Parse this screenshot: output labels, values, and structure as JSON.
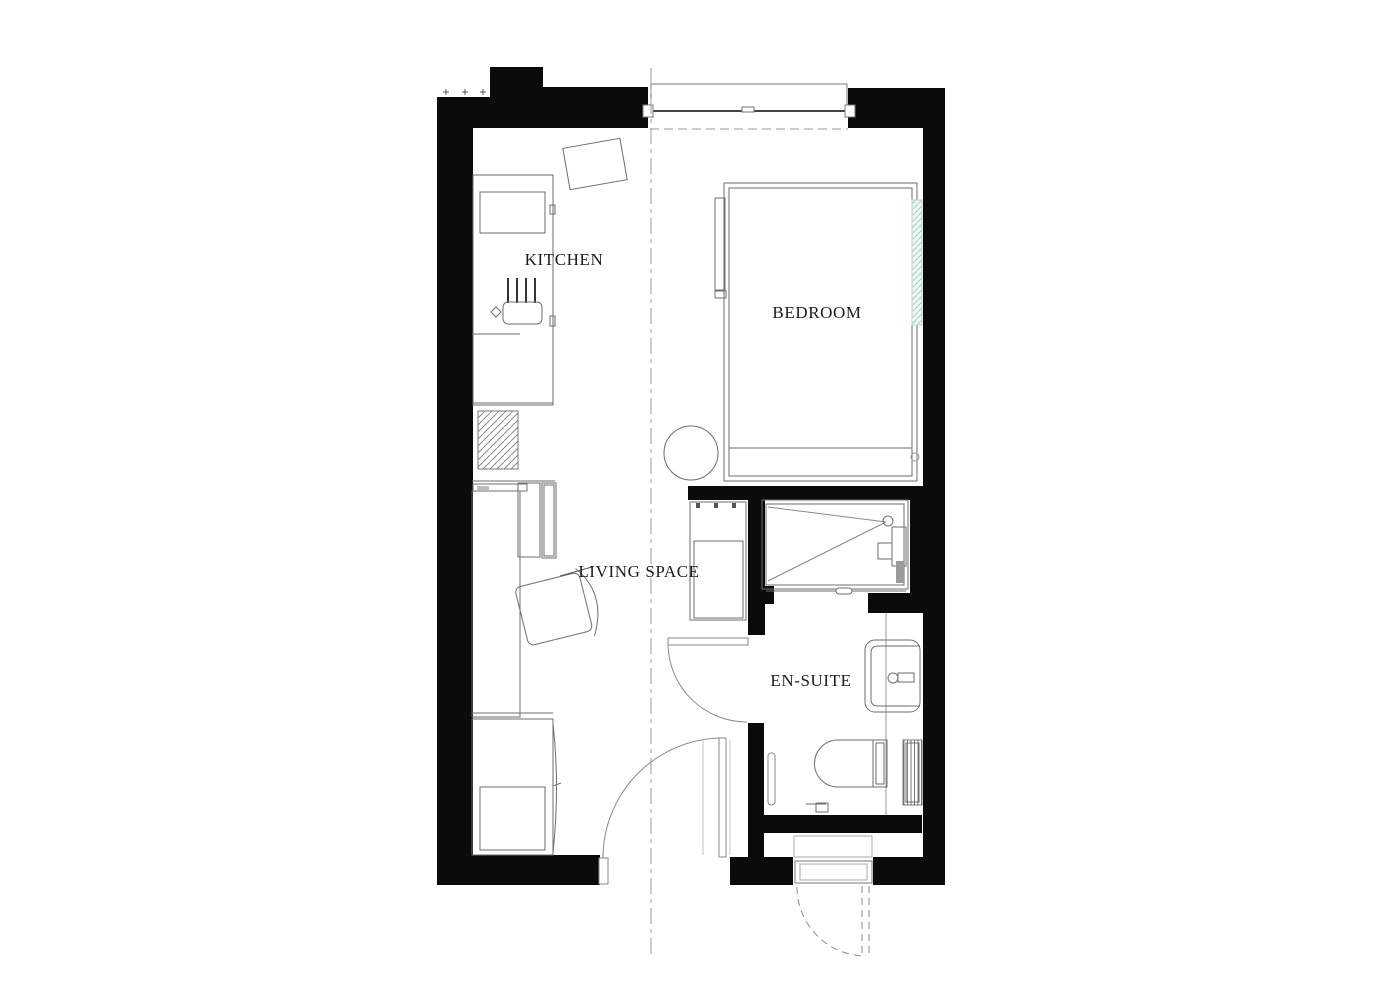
{
  "plan": {
    "type": "floor-plan",
    "rooms": [
      {
        "id": "kitchen",
        "label": "KITCHEN"
      },
      {
        "id": "bedroom",
        "label": "BEDROOM"
      },
      {
        "id": "living_space",
        "label": "LIVING SPACE"
      },
      {
        "id": "en_suite",
        "label": "EN-SUITE"
      }
    ],
    "colors": {
      "wall": "#0b0b0b",
      "line": "#6e6e6e",
      "background": "#ffffff",
      "hatch_gray": "#8a8a8a",
      "hatch_teal": "#a8cfbc",
      "hatch_teal_bg": "#eef7f1",
      "text": "#1c1c1c"
    }
  }
}
